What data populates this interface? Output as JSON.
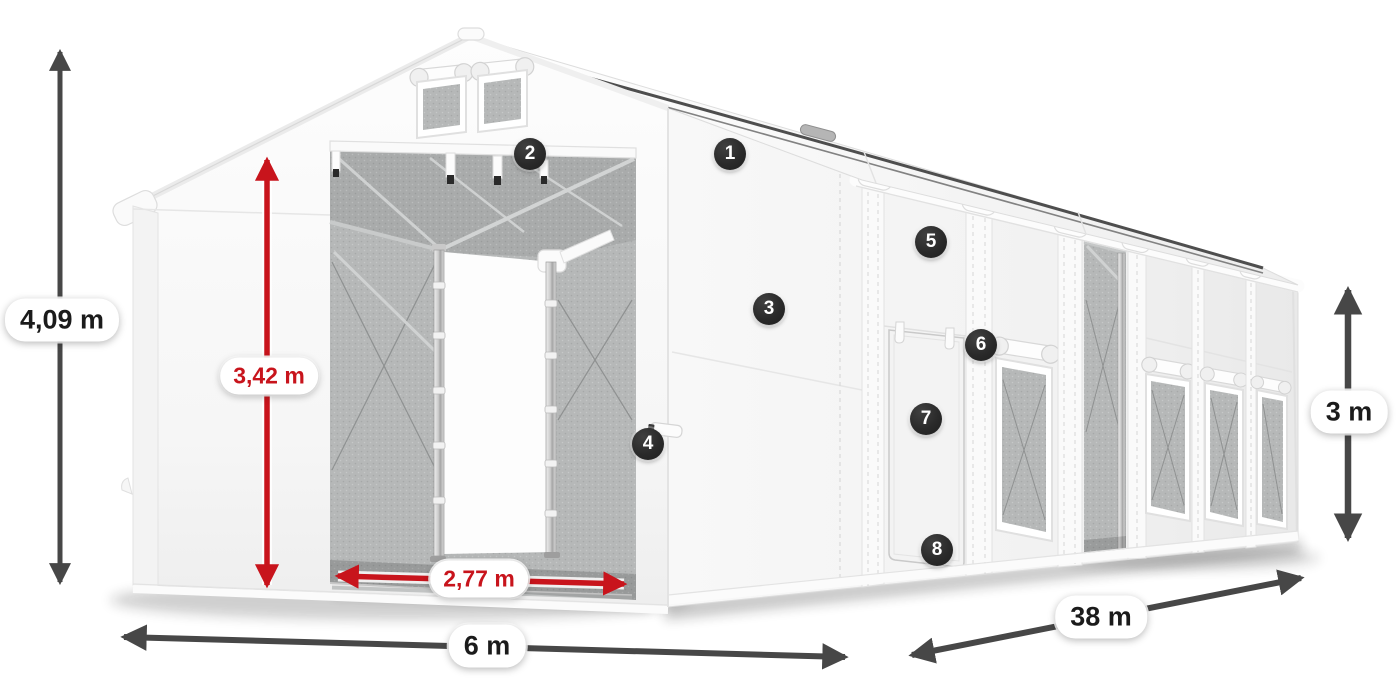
{
  "diagram": {
    "subject": "storage-tent-dimension-diagram"
  },
  "dimensions": {
    "total_height": "4,09 m",
    "entrance_height": "3,42 m",
    "entrance_width": "2,77 m",
    "front_width": "6 m",
    "side_length": "38 m",
    "side_wall_height": "3 m"
  },
  "badges": [
    {
      "label": "1"
    },
    {
      "label": "2"
    },
    {
      "label": "3"
    },
    {
      "label": "4"
    },
    {
      "label": "5"
    },
    {
      "label": "6"
    },
    {
      "label": "7"
    },
    {
      "label": "8"
    }
  ],
  "colors": {
    "dimension_arrow_dark": "#474747",
    "dimension_arrow_red": "#c8141c",
    "badge_background": "#2a2a2a",
    "label_text": "#1b1b1b",
    "tent_fabric": "#f7f7f7",
    "mesh_gray": "#b6b8b8"
  }
}
